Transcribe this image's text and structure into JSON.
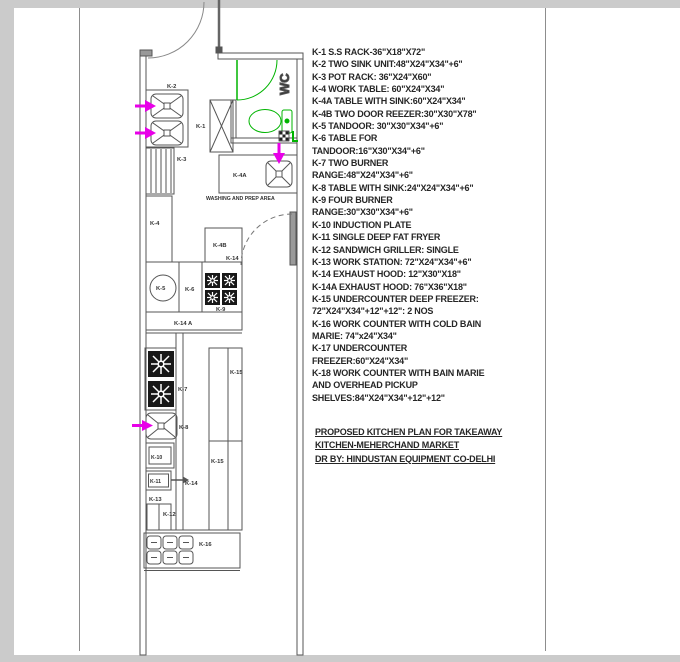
{
  "plan": {
    "wc_label": "WC",
    "area_label": "WASHING AND PREP AREA",
    "labels": {
      "k1": "K-1",
      "k2": "K-2",
      "k3": "K-3",
      "k4": "K-4",
      "k4a": "K-4A",
      "k4b": "K-4B",
      "k5": "K-5",
      "k6": "K-6",
      "k7": "K-7",
      "k8": "K-8",
      "k9": "K-9",
      "k10": "K-10",
      "k11": "K-11",
      "k12": "K-12",
      "k13": "K-13",
      "k14_top": "K-14",
      "k14_mid": "K-14",
      "k14a_band": "K-14 A",
      "k15_upper": "K-15",
      "k15_lower": "K-15",
      "k16": "K-16"
    }
  },
  "legend": {
    "lines": [
      "K-1 S.S RACK-36\"X18\"X72\"",
      "K-2 TWO SINK UNIT:48\"X24\"X34\"+6\"",
      "K-3 POT RACK: 36\"X24\"X60\"",
      "K-4 WORK TABLE: 60\"X24\"X34\"",
      "K-4A TABLE WITH SINK:60\"X24\"X34\"",
      "K-4B TWO DOOR REEZER:30\"X30\"X78\"",
      "K-5 TANDOOR: 30\"X30\"X34\"+6\"",
      "K-6 TABLE FOR",
      "TANDOOR:16\"X30\"X34\"+6\"",
      "K-7 TWO BURNER",
      "RANGE:48\"X24\"X34\"+6\"",
      "K-8 TABLE WITH SINK:24\"X24\"X34\"+6\"",
      "K-9 FOUR BURNER",
      "RANGE:30\"X30\"X34\"+6\"",
      "K-10 INDUCTION PLATE",
      "K-11 SINGLE DEEP FAT FRYER",
      "K-12 SANDWICH GRILLER: SINGLE",
      "K-13 WORK STATION: 72\"X24\"X34\"+6\"",
      "K-14 EXHAUST HOOD: 12\"X30\"X18\"",
      "K-14A EXHAUST HOOD: 76\"X36\"X18\"",
      "K-15 UNDERCOUNTER DEEP FREEZER:",
      "72\"X24\"X34\"+12\"+12\": 2 NOS",
      "K-16 WORK COUNTER WITH COLD BAIN",
      "MARIE: 74\"x24\"X34\"",
      "K-17 UNDERCOUNTER",
      "FREEZER:60\"X24\"X34\"",
      "K-18 WORK COUNTER WITH BAIN MARIE",
      "AND OVERHEAD PICKUP",
      "SHELVES:84\"X24\"X34\"+12\"+12\""
    ]
  },
  "title_block": {
    "lines": [
      "PROPOSED KITCHEN PLAN FOR TAKEAWAY",
      "KITCHEN-MEHERCHAND MARKET",
      "DR BY: HINDUSTAN EQUIPMENT CO-DELHI"
    ]
  },
  "colors": {
    "wall_line": "#555555",
    "supply_arrow_magenta": "#e800e8",
    "wc_green": "#00b400",
    "legend_text": "#262626",
    "sheet_margin_gray": "#cbcbcb"
  }
}
